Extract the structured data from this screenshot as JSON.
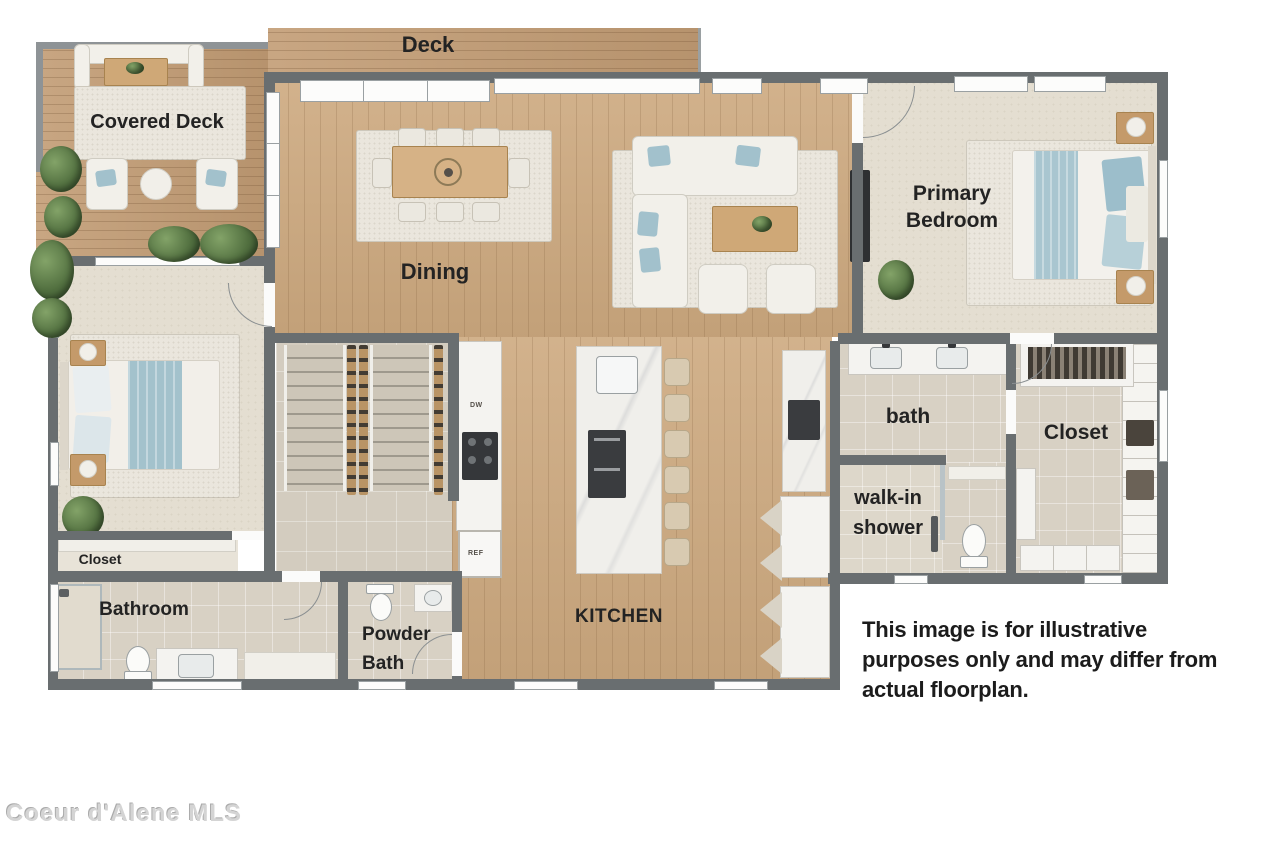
{
  "image_type": "residential floor plan rendering",
  "labels": {
    "deck": "Deck",
    "covered_deck": "Covered Deck",
    "dining": "Dining",
    "primary_bedroom": "Primary Bedroom",
    "bath": "bath",
    "primary_closet": "Closet",
    "walk_in_shower": "walk-in shower",
    "kitchen": "KITCHEN",
    "bedroom_closet": "Closet",
    "bathroom": "Bathroom",
    "powder_bath": "Powder Bath"
  },
  "appliances": {
    "dishwasher": "DW",
    "refrigerator": "REF"
  },
  "disclaimer": {
    "lines": [
      "This image is for illustrative",
      "purposes only and may differ from",
      "actual floorplan."
    ]
  },
  "watermark": "Coeur d'Alene MLS",
  "palette": {
    "wall": "#696e70",
    "deck_wood": "#c29c74",
    "interior_wood": "#cda97f",
    "carpet": "#e4ded1",
    "tile": "#d8d1c4",
    "accent_blue": "#a2c1cc",
    "furniture_wood": "#c49a6a",
    "label_text": "#232323",
    "background": "#ffffff"
  }
}
